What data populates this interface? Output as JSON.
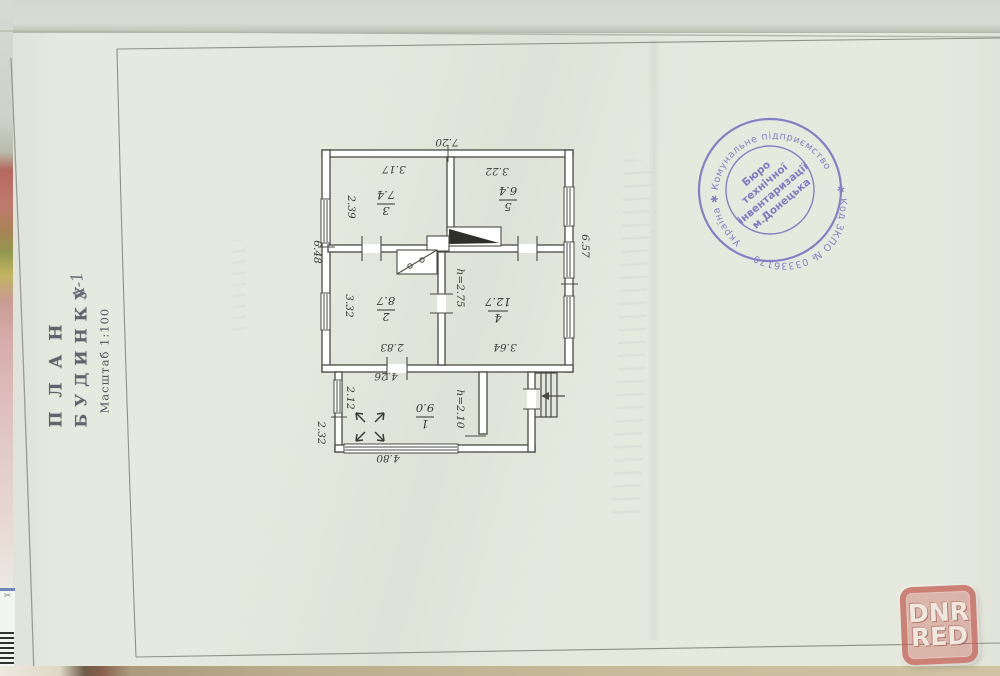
{
  "document": {
    "title_block": {
      "title_line1": "ПЛАН",
      "title_line2": "БУДИНКУ",
      "litera": "А-1",
      "scale": "Масштаб 1:100"
    },
    "stamp": {
      "ring_top": "Україна ✱ Комунальне підприємство",
      "ring_bottom": "✱ Код ЗКПО № 03336170",
      "center_line1": "Бюро",
      "center_line2": "технічної",
      "center_line3": "інвентаризації",
      "center_line4": "м.Донецька"
    },
    "watermark": {
      "line1": "DNR",
      "line2": "RED"
    },
    "edge_number": "09",
    "edge_label_icon": "✂"
  },
  "plan": {
    "rooms": {
      "r1": {
        "num": "1",
        "area": "9.0"
      },
      "r2": {
        "num": "2",
        "area": "8.7"
      },
      "r3": {
        "num": "3",
        "area": "7.4"
      },
      "r4": {
        "num": "4",
        "area": "12.7"
      },
      "r5": {
        "num": "5",
        "area": "6.4"
      }
    },
    "dims": {
      "overall_width": "7.20",
      "room3_width": "3.17",
      "room5_width": "3.22",
      "room3_depth": "2.39",
      "left_side": "6.48",
      "room2_depth": "3.32",
      "room2_width": "2.83",
      "room4_width": "3.64",
      "right_side": "6.57",
      "room1_width": "4.26",
      "room1_depth": "2.12",
      "annex_side": "2.32",
      "annex_width": "4.80",
      "room4_height": "h=2.75",
      "room1_height": "h=2.10"
    }
  }
}
